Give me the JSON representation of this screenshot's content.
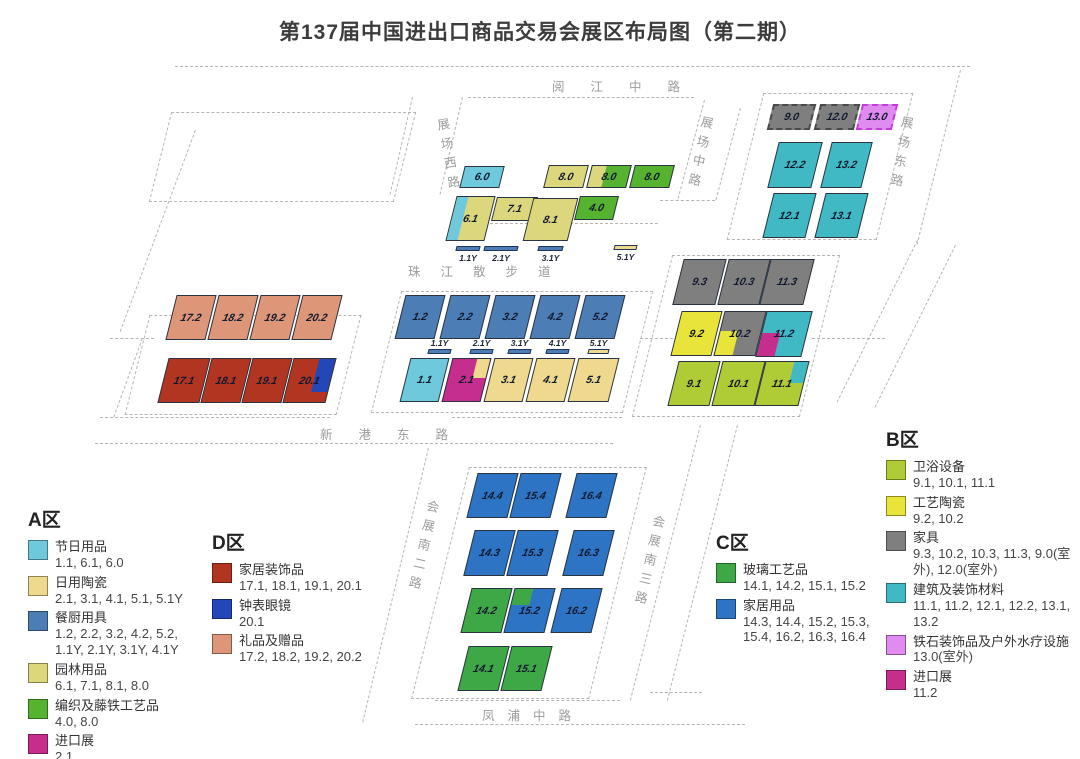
{
  "title": "第137届中国进出口商品交易会展区布局图（第二期）",
  "roads": {
    "yuejiang": "阅江中路",
    "zhanchang_xi": "展场西路",
    "zhanchang_zhong": "展场中路",
    "zhanchang_dong": "展场东路",
    "zhujiang": "珠江散步道",
    "xingang": "新港东路",
    "huizhan_nan2": "会展南二路",
    "huizhan_nan3": "会展南三路",
    "fengpu": "凤浦中路"
  },
  "colors": {
    "festival_cyan": "#6EC9DC",
    "ceramics_khaki": "#EFD98E",
    "kitchen_blue": "#4C7DB5",
    "garden_olive": "#DCD77D",
    "weave_green": "#55B32F",
    "import_magenta": "#C52E8C",
    "d_red": "#B23522",
    "d_blue": "#2347B8",
    "d_salmon": "#DE9678",
    "b_sanitary_yg": "#AFCB35",
    "b_ceramic_yellow": "#E9E43A",
    "b_furniture_gray": "#7F7F7F",
    "b_building_teal": "#41B9C4",
    "b_spa_violet": "#E08BF0",
    "c_glass_green": "#3EA847",
    "c_home_blue": "#2D74C4"
  },
  "map": {
    "halls": [
      {
        "id": "6.0",
        "x": 462,
        "y": 166,
        "w": 40,
        "h": 22,
        "fill": "festival_cyan"
      },
      {
        "id": "8.0a",
        "label": "8.0",
        "x": 546,
        "y": 165,
        "w": 40,
        "h": 23,
        "fill": "garden_olive"
      },
      {
        "id": "8.0b",
        "label": "8.0",
        "x": 589,
        "y": 165,
        "w": 40,
        "h": 23,
        "fill": "weave_green",
        "patch": {
          "corner": "tl",
          "w": 38,
          "h": 100,
          "color": "garden_olive"
        }
      },
      {
        "id": "8.0c",
        "label": "8.0",
        "x": 632,
        "y": 165,
        "w": 40,
        "h": 23,
        "fill": "weave_green"
      },
      {
        "id": "6.1",
        "x": 451,
        "y": 196,
        "w": 39,
        "h": 45,
        "fill": "garden_olive",
        "patch": {
          "corner": "tl",
          "w": 30,
          "h": 100,
          "color": "festival_cyan"
        }
      },
      {
        "id": "7.1",
        "x": 494,
        "y": 197,
        "w": 41,
        "h": 24,
        "fill": "garden_olive"
      },
      {
        "id": "8.1",
        "x": 528,
        "y": 198,
        "w": 45,
        "h": 43,
        "fill": "garden_olive"
      },
      {
        "id": "4.0",
        "x": 577,
        "y": 196,
        "w": 39,
        "h": 24,
        "fill": "weave_green"
      },
      {
        "id": "9.0",
        "x": 770,
        "y": 104,
        "w": 43,
        "h": 26,
        "fill": "b_furniture_gray",
        "dashed": true
      },
      {
        "id": "12.0",
        "x": 817,
        "y": 104,
        "w": 40,
        "h": 26,
        "fill": "b_furniture_gray",
        "dashed": true
      },
      {
        "id": "13.0",
        "x": 859,
        "y": 104,
        "w": 36,
        "h": 26,
        "fill": "b_spa_violet",
        "dashed": true,
        "border": "#c03fd4"
      },
      {
        "id": "12.2",
        "x": 773,
        "y": 142,
        "w": 44,
        "h": 46,
        "fill": "b_building_teal"
      },
      {
        "id": "13.2",
        "x": 826,
        "y": 142,
        "w": 41,
        "h": 46,
        "fill": "b_building_teal"
      },
      {
        "id": "12.1",
        "x": 768,
        "y": 193,
        "w": 43,
        "h": 45,
        "fill": "b_building_teal"
      },
      {
        "id": "13.1",
        "x": 820,
        "y": 193,
        "w": 43,
        "h": 45,
        "fill": "b_building_teal"
      },
      {
        "id": "9.3",
        "x": 678,
        "y": 259,
        "w": 43,
        "h": 46,
        "fill": "b_furniture_gray"
      },
      {
        "id": "10.3",
        "x": 723,
        "y": 259,
        "w": 42,
        "h": 46,
        "fill": "b_furniture_gray"
      },
      {
        "id": "11.3",
        "x": 765,
        "y": 259,
        "w": 44,
        "h": 46,
        "fill": "b_furniture_gray"
      },
      {
        "id": "9.2",
        "x": 676,
        "y": 311,
        "w": 41,
        "h": 45,
        "fill": "b_ceramic_yellow"
      },
      {
        "id": "10.2",
        "x": 719,
        "y": 311,
        "w": 42,
        "h": 45,
        "fill": "b_furniture_gray",
        "patch": {
          "corner": "bl",
          "w": 45,
          "h": 55,
          "color": "b_ceramic_yellow"
        }
      },
      {
        "id": "11.2",
        "x": 761,
        "y": 311,
        "w": 46,
        "h": 46,
        "fill": "b_building_teal",
        "patch": {
          "corner": "bl",
          "w": 42,
          "h": 52,
          "color": "import_magenta"
        }
      },
      {
        "id": "9.1",
        "x": 673,
        "y": 361,
        "w": 42,
        "h": 45,
        "fill": "b_sanitary_yg"
      },
      {
        "id": "10.1",
        "x": 717,
        "y": 361,
        "w": 43,
        "h": 45,
        "fill": "b_sanitary_yg"
      },
      {
        "id": "11.1",
        "x": 760,
        "y": 361,
        "w": 44,
        "h": 45,
        "fill": "b_sanitary_yg",
        "patch": {
          "corner": "tr",
          "w": 34,
          "h": 48,
          "color": "b_building_teal"
        }
      },
      {
        "id": "17.2",
        "x": 171,
        "y": 295,
        "w": 40,
        "h": 45,
        "fill": "d_salmon"
      },
      {
        "id": "18.2",
        "x": 213,
        "y": 295,
        "w": 40,
        "h": 45,
        "fill": "d_salmon"
      },
      {
        "id": "19.2",
        "x": 255,
        "y": 295,
        "w": 40,
        "h": 45,
        "fill": "d_salmon"
      },
      {
        "id": "20.2",
        "x": 297,
        "y": 295,
        "w": 40,
        "h": 45,
        "fill": "d_salmon"
      },
      {
        "id": "17.1",
        "x": 163,
        "y": 358,
        "w": 42,
        "h": 45,
        "fill": "d_red"
      },
      {
        "id": "18.1",
        "x": 206,
        "y": 358,
        "w": 40,
        "h": 45,
        "fill": "d_red"
      },
      {
        "id": "19.1",
        "x": 247,
        "y": 358,
        "w": 40,
        "h": 45,
        "fill": "d_red"
      },
      {
        "id": "20.1",
        "x": 288,
        "y": 358,
        "w": 43,
        "h": 45,
        "fill": "d_red",
        "patch": {
          "corner": "tr",
          "w": 38,
          "h": 76,
          "color": "d_blue"
        }
      },
      {
        "id": "1.2",
        "x": 400,
        "y": 295,
        "w": 40,
        "h": 44,
        "fill": "kitchen_blue"
      },
      {
        "id": "2.2",
        "x": 445,
        "y": 295,
        "w": 40,
        "h": 44,
        "fill": "kitchen_blue"
      },
      {
        "id": "3.2",
        "x": 490,
        "y": 295,
        "w": 40,
        "h": 44,
        "fill": "kitchen_blue"
      },
      {
        "id": "4.2",
        "x": 535,
        "y": 295,
        "w": 40,
        "h": 44,
        "fill": "kitchen_blue"
      },
      {
        "id": "5.2",
        "x": 580,
        "y": 295,
        "w": 40,
        "h": 44,
        "fill": "kitchen_blue"
      },
      {
        "id": "1.1",
        "x": 405,
        "y": 358,
        "w": 39,
        "h": 44,
        "fill": "festival_cyan"
      },
      {
        "id": "2.1",
        "x": 447,
        "y": 358,
        "w": 39,
        "h": 44,
        "fill": "import_magenta",
        "patch": {
          "corner": "tr",
          "w": 36,
          "h": 45,
          "color": "ceramics_khaki"
        }
      },
      {
        "id": "3.1",
        "x": 489,
        "y": 358,
        "w": 39,
        "h": 44,
        "fill": "ceramics_khaki"
      },
      {
        "id": "4.1",
        "x": 531,
        "y": 358,
        "w": 39,
        "h": 44,
        "fill": "ceramics_khaki"
      },
      {
        "id": "5.1",
        "x": 573,
        "y": 358,
        "w": 41,
        "h": 44,
        "fill": "ceramics_khaki"
      },
      {
        "id": "14.4",
        "x": 472,
        "y": 473,
        "w": 41,
        "h": 45,
        "fill": "c_home_blue"
      },
      {
        "id": "15.4",
        "x": 515,
        "y": 473,
        "w": 41,
        "h": 45,
        "fill": "c_home_blue"
      },
      {
        "id": "16.4",
        "x": 571,
        "y": 473,
        "w": 41,
        "h": 45,
        "fill": "c_home_blue"
      },
      {
        "id": "14.3",
        "x": 469,
        "y": 530,
        "w": 41,
        "h": 46,
        "fill": "c_home_blue"
      },
      {
        "id": "15.3",
        "x": 512,
        "y": 530,
        "w": 41,
        "h": 46,
        "fill": "c_home_blue"
      },
      {
        "id": "16.3",
        "x": 568,
        "y": 530,
        "w": 41,
        "h": 46,
        "fill": "c_home_blue"
      },
      {
        "id": "14.2",
        "x": 466,
        "y": 588,
        "w": 41,
        "h": 45,
        "fill": "c_glass_green"
      },
      {
        "id": "15.2",
        "x": 509,
        "y": 588,
        "w": 41,
        "h": 45,
        "fill": "c_home_blue",
        "patch": {
          "corner": "tl",
          "w": 45,
          "h": 38,
          "color": "c_glass_green"
        }
      },
      {
        "id": "16.2",
        "x": 556,
        "y": 588,
        "w": 41,
        "h": 45,
        "fill": "c_home_blue"
      },
      {
        "id": "14.1",
        "x": 463,
        "y": 646,
        "w": 41,
        "h": 45,
        "fill": "c_glass_green"
      },
      {
        "id": "15.1",
        "x": 506,
        "y": 646,
        "w": 41,
        "h": 45,
        "fill": "c_glass_green"
      }
    ],
    "ybars": [
      {
        "label": "1.1Y",
        "x": 456,
        "y": 246,
        "w": 24,
        "color": "kitchen_blue",
        "labelPos": "below"
      },
      {
        "label": "2.1Y",
        "x": 484,
        "y": 246,
        "w": 34,
        "color": "kitchen_blue",
        "labelPos": "below"
      },
      {
        "label": "3.1Y",
        "x": 538,
        "y": 246,
        "w": 25,
        "color": "kitchen_blue",
        "labelPos": "below"
      },
      {
        "label": "5.1Y",
        "x": 614,
        "y": 245,
        "w": 23,
        "color": "ceramics_khaki",
        "labelPos": "below"
      },
      {
        "label": "1.1Y",
        "x": 428,
        "y": 349,
        "w": 23,
        "color": "kitchen_blue",
        "labelPos": "above"
      },
      {
        "label": "2.1Y",
        "x": 470,
        "y": 349,
        "w": 23,
        "color": "kitchen_blue",
        "labelPos": "above"
      },
      {
        "label": "3.1Y",
        "x": 508,
        "y": 349,
        "w": 23,
        "color": "kitchen_blue",
        "labelPos": "above"
      },
      {
        "label": "4.1Y",
        "x": 546,
        "y": 349,
        "w": 23,
        "color": "kitchen_blue",
        "labelPos": "above"
      },
      {
        "label": "5.1Y",
        "x": 588,
        "y": 349,
        "w": 21,
        "color": "ceramics_khaki",
        "labelPos": "above"
      }
    ]
  },
  "legends": [
    {
      "title": "A区",
      "items": [
        {
          "name": "节日用品",
          "codes": "1.1, 6.1, 6.0",
          "color": "festival_cyan"
        },
        {
          "name": "日用陶瓷",
          "codes": "2.1, 3.1, 4.1, 5.1, 5.1Y",
          "color": "ceramics_khaki"
        },
        {
          "name": "餐厨用具",
          "codes": "1.2, 2.2, 3.2, 4.2, 5.2, 1.1Y, 2.1Y, 3.1Y, 4.1Y",
          "color": "kitchen_blue"
        },
        {
          "name": "园林用品",
          "codes": "6.1, 7.1, 8.1, 8.0",
          "color": "garden_olive"
        },
        {
          "name": "编织及藤铁工艺品",
          "codes": "4.0, 8.0",
          "color": "weave_green"
        },
        {
          "name": "进口展",
          "codes": "2.1",
          "color": "import_magenta"
        }
      ]
    },
    {
      "title": "D区",
      "items": [
        {
          "name": "家居装饰品",
          "codes": "17.1, 18.1, 19.1, 20.1",
          "color": "d_red"
        },
        {
          "name": "钟表眼镜",
          "codes": "20.1",
          "color": "d_blue"
        },
        {
          "name": "礼品及赠品",
          "codes": "17.2, 18.2, 19.2, 20.2",
          "color": "d_salmon"
        }
      ]
    },
    {
      "title": "C区",
      "items": [
        {
          "name": "玻璃工艺品",
          "codes": "14.1, 14.2, 15.1, 15.2",
          "color": "c_glass_green"
        },
        {
          "name": "家居用品",
          "codes": "14.3, 14.4, 15.2, 15.3, 15.4, 16.2, 16.3, 16.4",
          "color": "c_home_blue"
        }
      ]
    },
    {
      "title": "B区",
      "items": [
        {
          "name": "卫浴设备",
          "codes": "9.1, 10.1, 11.1",
          "color": "b_sanitary_yg"
        },
        {
          "name": "工艺陶瓷",
          "codes": "9.2, 10.2",
          "color": "b_ceramic_yellow"
        },
        {
          "name": "家具",
          "codes": "9.3, 10.2, 10.3, 11.3, 9.0(室外), 12.0(室外)",
          "color": "b_furniture_gray"
        },
        {
          "name": "建筑及装饰材料",
          "codes": "11.1, 11.2, 12.1, 12.2, 13.1, 13.2",
          "color": "b_building_teal"
        },
        {
          "name": "铁石装饰品及户外水疗设施",
          "codes": "13.0(室外)",
          "color": "b_spa_violet"
        },
        {
          "name": "进口展",
          "codes": "11.2",
          "color": "import_magenta"
        }
      ]
    }
  ]
}
